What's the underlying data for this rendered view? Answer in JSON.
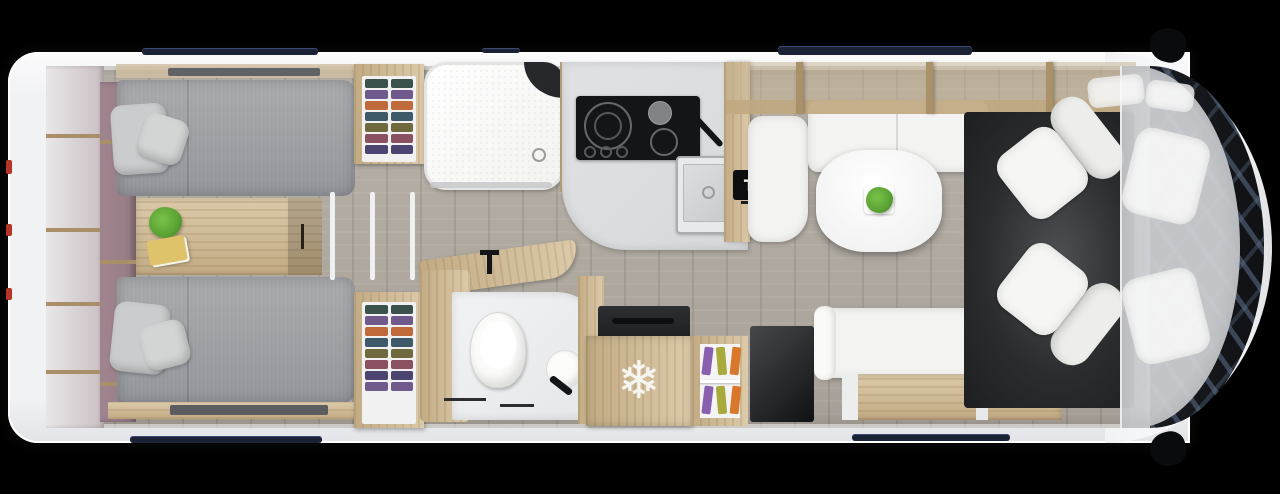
{
  "scene": {
    "title": "RV floor plan top view",
    "labels": {
      "tv": "TV"
    },
    "icons": {
      "snowflake": "❄"
    },
    "colors": {
      "bg": "#000000",
      "body": "#f1f2f4",
      "body-line": "#d9dbde",
      "floor-a": "#b7b1a8",
      "floor-b": "#a7a198",
      "wood-a": "#dccaaa",
      "wood-b": "#c2ab84",
      "wood-dark": "#a98f67",
      "mauve": "#967b83",
      "mattress-a": "#a8aaad",
      "mattress-b": "#92959a",
      "pillow": "#cbcccd",
      "counter": "#d6d8da",
      "furn-white": "#f3f3f1",
      "appliance": "#141518",
      "rug-a": "#4e5053",
      "rug-b": "#1d1e20",
      "navy": "#1b2236",
      "red": "#b53629",
      "green": "#5aa232",
      "book": "#dfc36a",
      "snow": "#f7f5f0",
      "overhead": "rgba(197,178,146,0.52)",
      "cab": "rgba(205,207,210,0.94)",
      "ghost": "rgba(250,250,250,0.85)",
      "windshield-a": "#191c21",
      "windshield-b": "#5c7089",
      "cl1": "#3a524b",
      "cl2": "#705a8c",
      "cl3": "#c06a3c",
      "cl4": "#3e5a6a",
      "cl5": "#6e6a3e",
      "cl6": "#8a5260",
      "cl7": "#4b4470",
      "m1": "#8a5fae",
      "m2": "#a8aa3c",
      "m3": "#d9782c"
    }
  }
}
